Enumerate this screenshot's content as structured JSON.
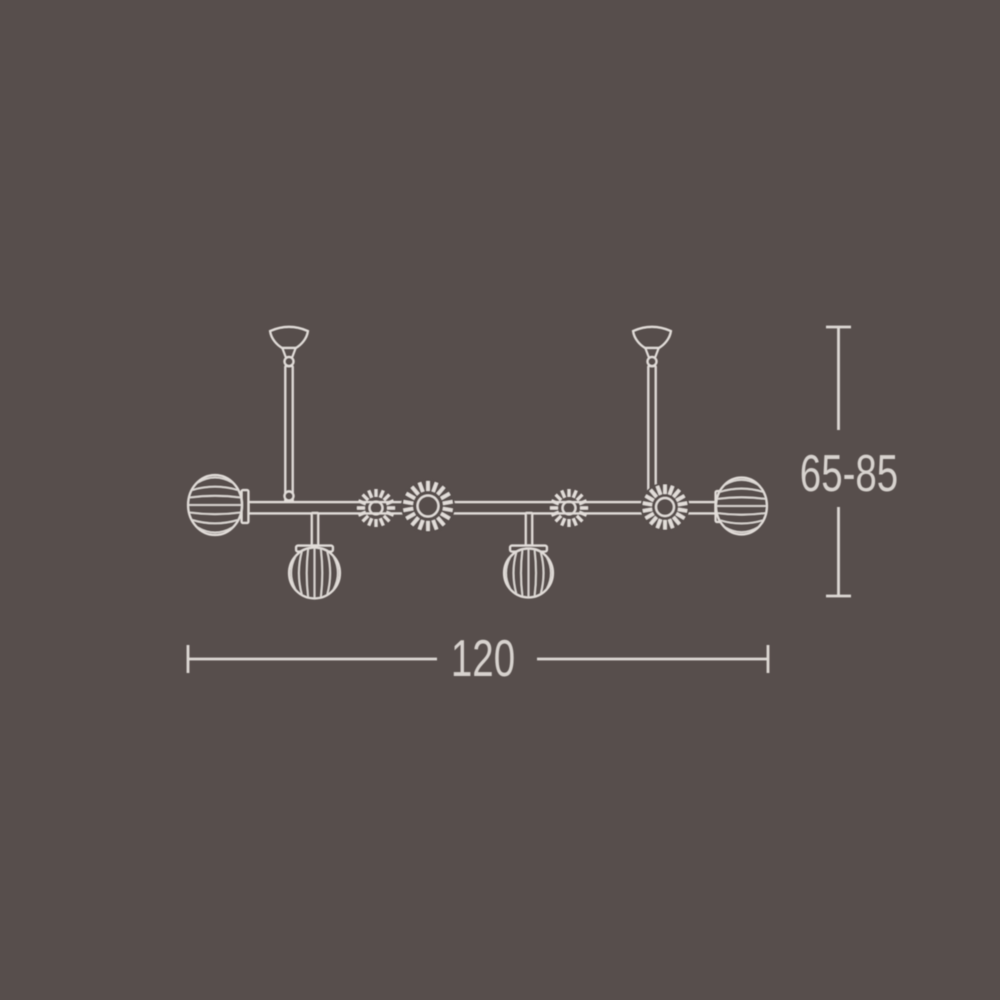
{
  "page": {
    "background_color": "#574e4c",
    "line_color": "#e2ddd9",
    "label_color": "#d7d2ce"
  },
  "diagram": {
    "type": "product-dimension-drawing",
    "subject": "linear suspension chandelier with two ceiling canopies, two ribbed end globes, two hanging ribbed pendant globes and four rosette shades on a horizontal bar",
    "dimension_labels": {
      "width": "120",
      "height": "65-85"
    }
  }
}
